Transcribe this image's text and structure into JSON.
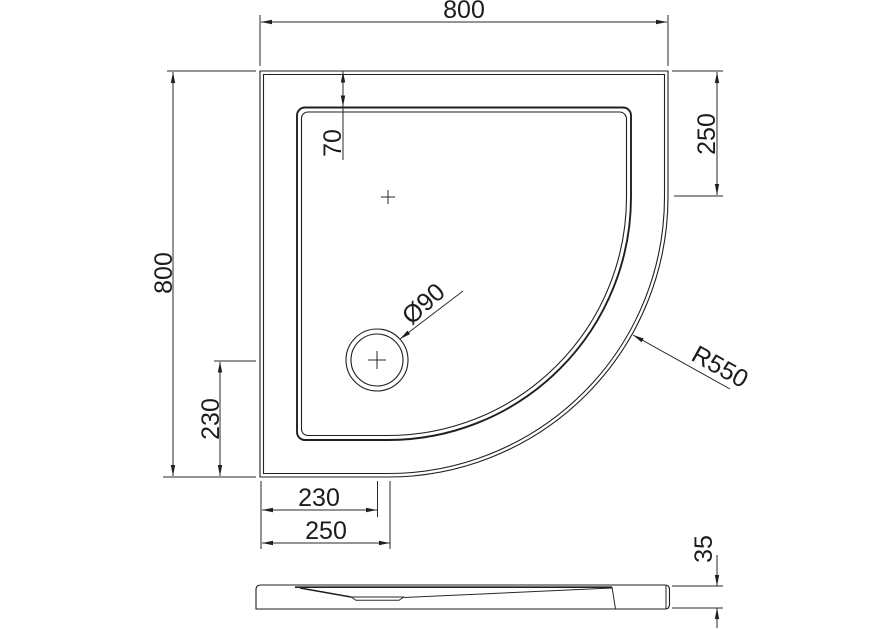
{
  "drawing": {
    "title": "Quadrant shower tray dimension drawing",
    "colors": {
      "background": "#ffffff",
      "line": "#1f1f1f"
    },
    "dimensions": {
      "overall_width": "800",
      "overall_depth": "800",
      "right_straight_edge": "250",
      "rim_width": "70",
      "drain_offset_vertical": "230",
      "drain_offset_horizontal": "230",
      "curve_start_offset": "250",
      "tray_height": "35",
      "corner_radius": "R550",
      "drain_diameter": "Ø90"
    }
  }
}
